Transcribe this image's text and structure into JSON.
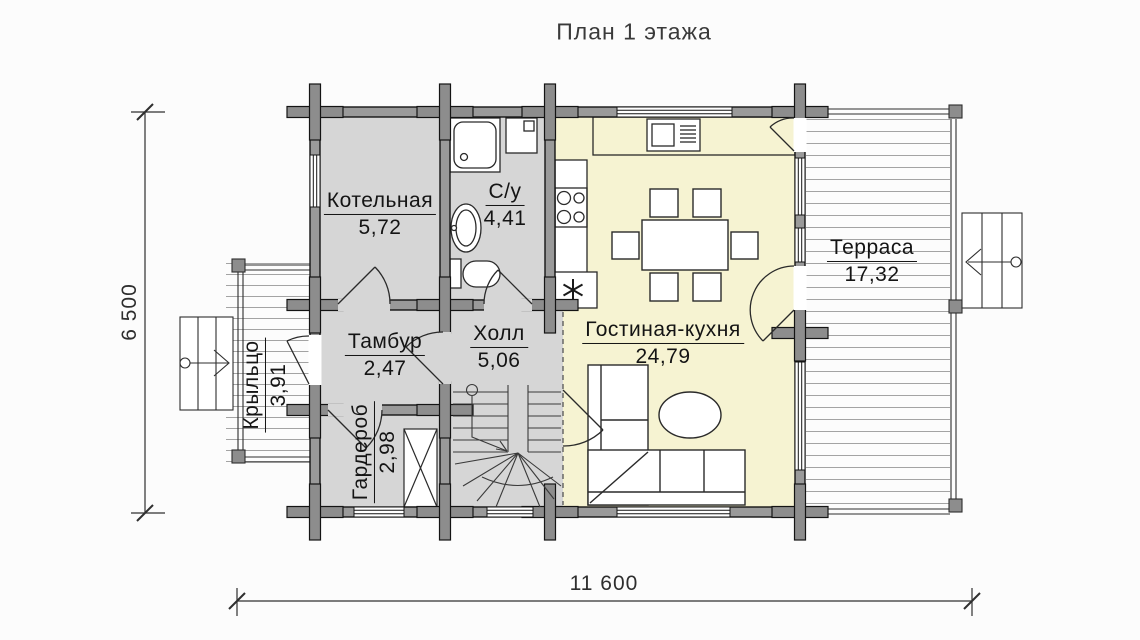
{
  "title": "План 1 этажа",
  "rooms": {
    "kotelnaya": {
      "name": "Котельная",
      "area": "5,72"
    },
    "su": {
      "name": "С/у",
      "area": "4,41"
    },
    "tambur": {
      "name": "Тамбур",
      "area": "2,47"
    },
    "holl": {
      "name": "Холл",
      "area": "5,06"
    },
    "gostinaya": {
      "name": "Гостиная-кухня",
      "area": "24,79"
    },
    "terrasa": {
      "name": "Терраса",
      "area": "17,32"
    },
    "kryltso": {
      "name": "Крыльцо",
      "area": "3,91"
    },
    "garderob": {
      "name": "Гардероб",
      "area": "2,98"
    }
  },
  "dimensions": {
    "overall_width": "11 600",
    "overall_depth": "6 500"
  },
  "symbols": {
    "appliance": "✳"
  },
  "colors": {
    "room_fill": "#d6d6d6",
    "living_fill": "#f6f3d2",
    "wall_fill": "#9a9a9a",
    "log_joint": "#8d8d8d",
    "line": "#1a1a1a"
  }
}
